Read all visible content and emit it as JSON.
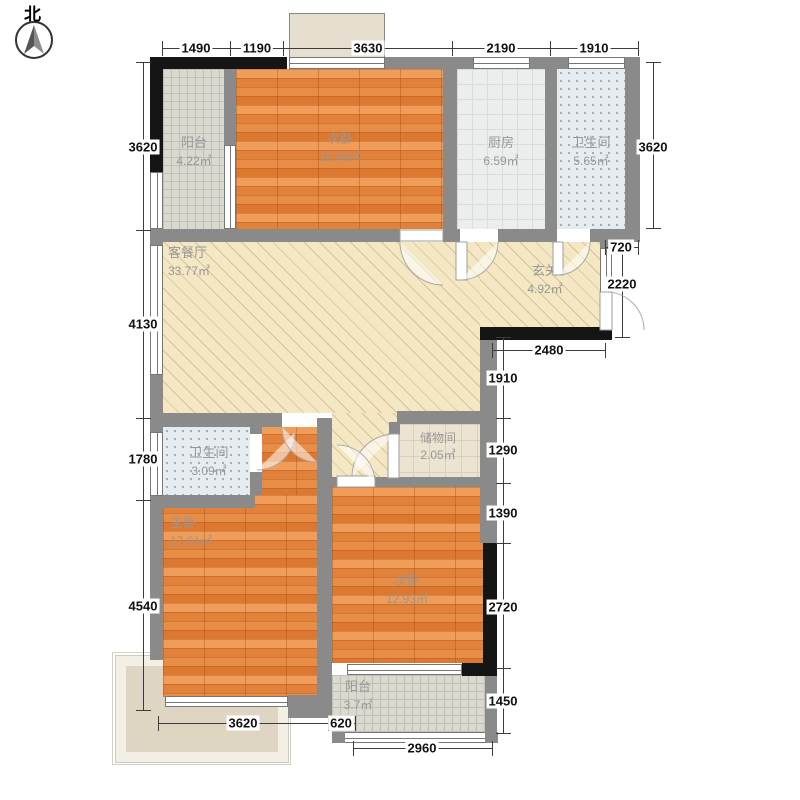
{
  "compass": {
    "north_label": "北"
  },
  "rooms": {
    "balcony_north": {
      "name": "阳台",
      "area": "4.22㎡"
    },
    "bedroom_north": {
      "name": "次卧",
      "area": "15.48㎡"
    },
    "kitchen": {
      "name": "厨房",
      "area": "6.59㎡"
    },
    "bathroom_north": {
      "name": "卫生间",
      "area": "5.65㎡"
    },
    "living_dining": {
      "name": "客餐厅",
      "area": "33.77㎡"
    },
    "foyer": {
      "name": "玄关",
      "area": "4.92㎡"
    },
    "storage": {
      "name": "储物间",
      "area": "2.05㎡"
    },
    "bathroom_south": {
      "name": "卫生间",
      "area": "3.09㎡"
    },
    "master_bedroom": {
      "name": "主卧",
      "area": "17.01㎡"
    },
    "bedroom_south": {
      "name": "次卧",
      "area": "12.93㎡"
    },
    "balcony_south": {
      "name": "阳台",
      "area": "3.7㎡"
    }
  },
  "dimensions_mm": {
    "top": [
      "1490",
      "1190",
      "3630",
      "2190",
      "1910"
    ],
    "left": [
      "3620",
      "4130",
      "1780",
      "4540"
    ],
    "right": [
      "3620",
      "720",
      "2220",
      "2480",
      "1910",
      "1290",
      "1390",
      "2720",
      "1450"
    ],
    "bottom": [
      "3620",
      "620",
      "2960"
    ]
  }
}
